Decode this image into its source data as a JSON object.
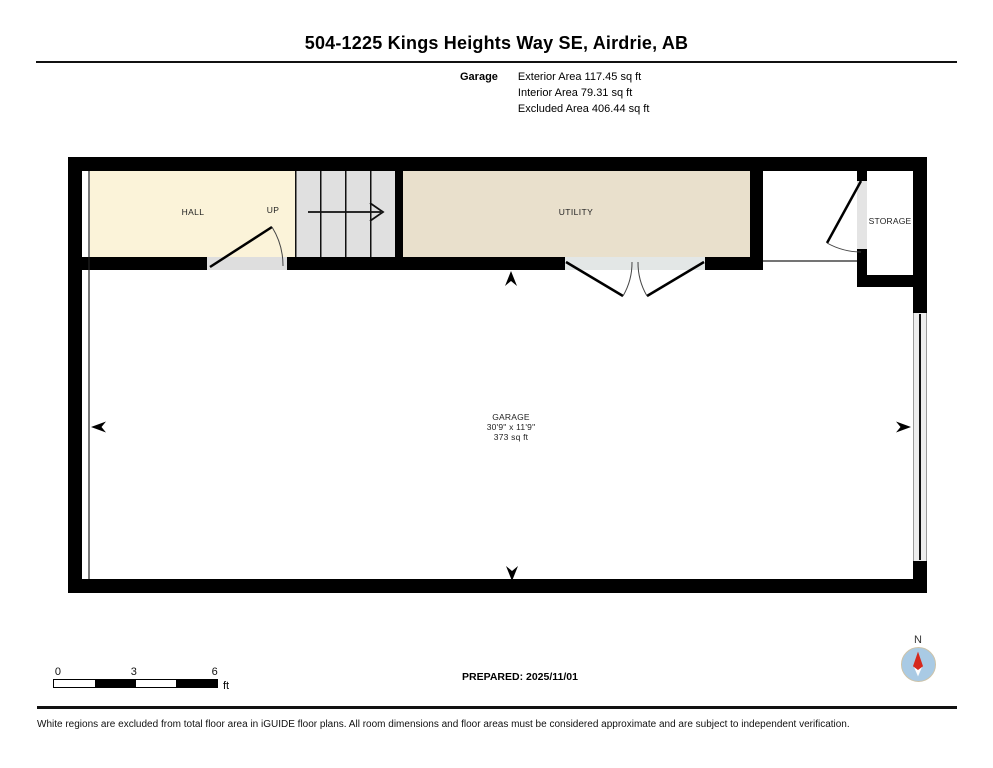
{
  "header": {
    "title": "504-1225 Kings Heights Way SE, Airdrie, AB",
    "floor_label": "Garage",
    "area_lines": [
      "Exterior Area 117.45 sq ft",
      "Interior Area 79.31 sq ft",
      "Excluded Area 406.44 sq ft"
    ]
  },
  "plan": {
    "rooms": {
      "hall": {
        "label": "HALL"
      },
      "stairs": {
        "label": "UP"
      },
      "utility": {
        "label": "UTILITY"
      },
      "storage": {
        "label": "STORAGE"
      },
      "garage": {
        "label": "GARAGE",
        "dimensions": "30'9\" x 11'9\"",
        "area": "373 sq ft"
      }
    },
    "colors": {
      "wall": "#000000",
      "hall_fill": "#fbf3d9",
      "utility_fill": "#e9e0cc",
      "stairs_fill": "#e0e0e0",
      "door_opening": "#dedede",
      "garage_door": "#ededed",
      "excluded_fill": "#ffffff"
    }
  },
  "footer": {
    "scale_bar": {
      "ticks": [
        "0",
        "3",
        "6"
      ],
      "unit": "ft"
    },
    "prepared": "PREPARED: 2025/11/01",
    "compass": {
      "label": "N",
      "needle_red": "#d6281c",
      "dial_blue": "#a9cae4"
    },
    "disclaimer": "White regions are excluded from total floor area in iGUIDE floor plans. All room dimensions and floor areas must be considered approximate and are subject to independent verification."
  }
}
